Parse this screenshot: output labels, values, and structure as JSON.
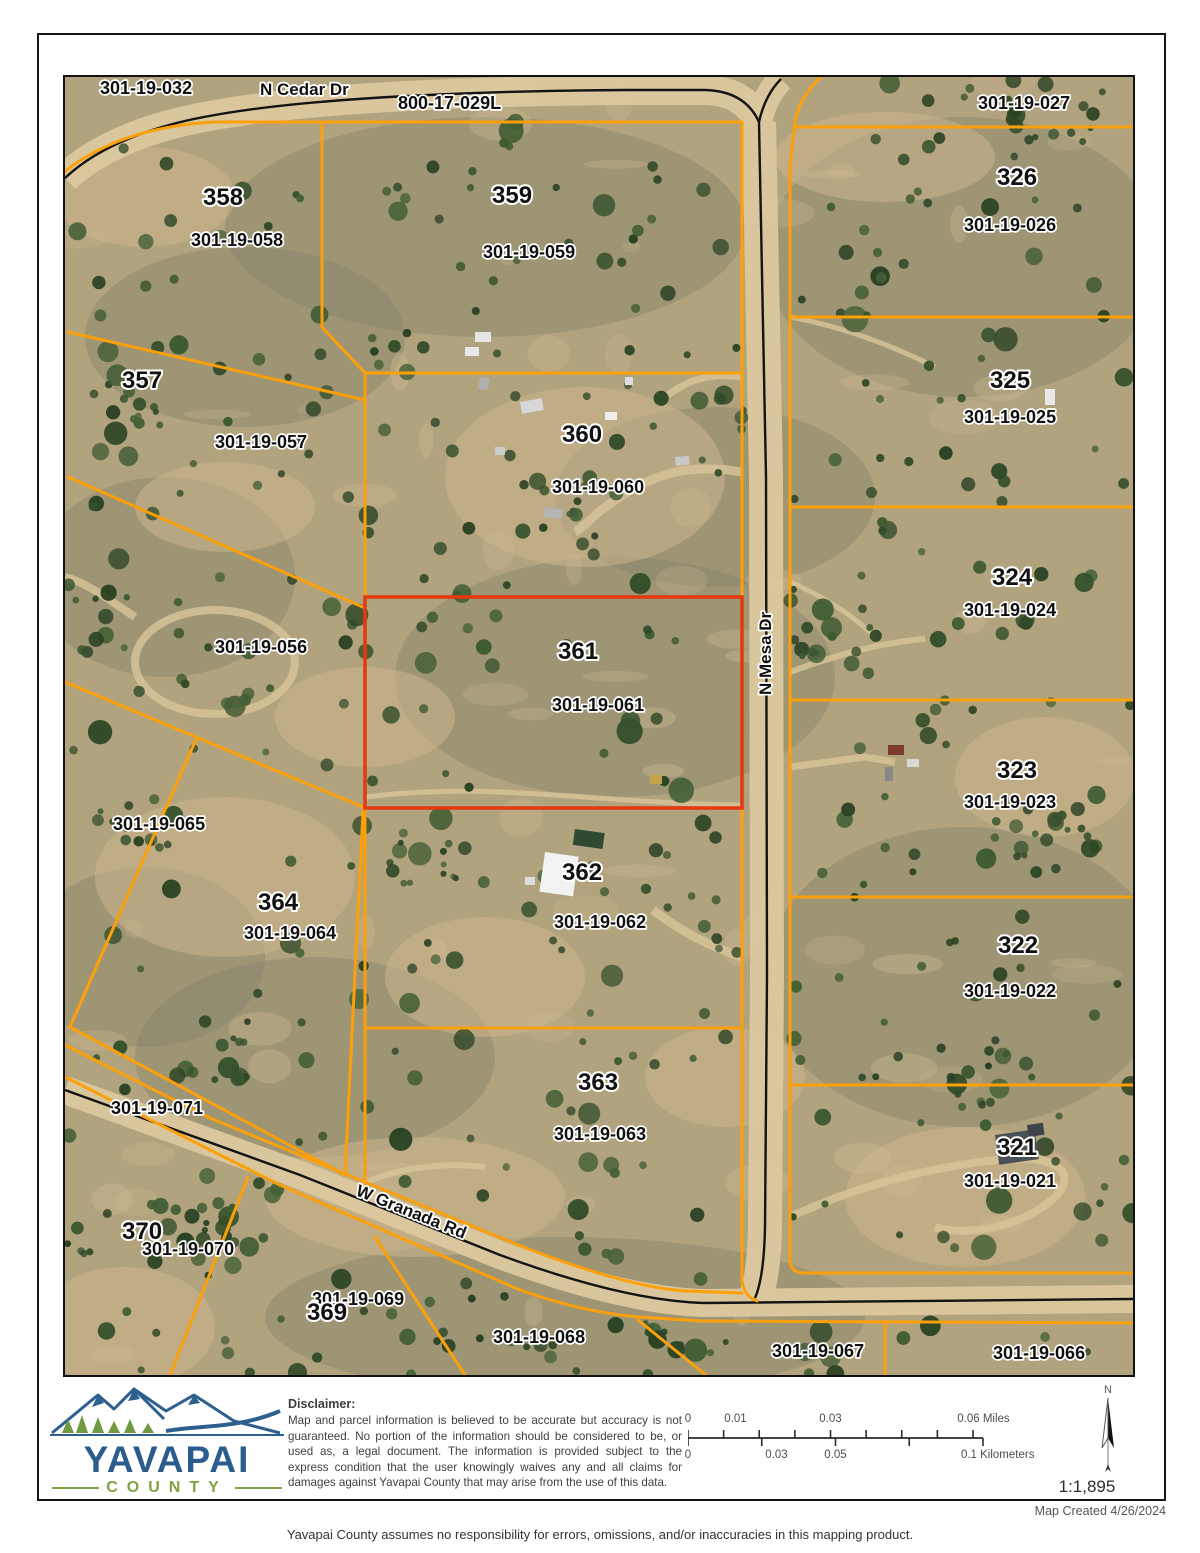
{
  "map": {
    "orange": "#fca00a",
    "highlight": "#e5380e",
    "labels": [
      {
        "text": "301-19-032",
        "x": 35,
        "y": 17,
        "size": 18,
        "kind": "apn"
      },
      {
        "text": "N Cedar Dr",
        "x": 195,
        "y": 18,
        "size": 17,
        "kind": "road"
      },
      {
        "text": "800-17-029L",
        "x": 333,
        "y": 32,
        "size": 18,
        "kind": "apn"
      },
      {
        "text": "358",
        "x": 138,
        "y": 128,
        "size": 24,
        "kind": "num"
      },
      {
        "text": "301-19-058",
        "x": 126,
        "y": 169,
        "size": 18,
        "kind": "apn"
      },
      {
        "text": "359",
        "x": 427,
        "y": 126,
        "size": 24,
        "kind": "num"
      },
      {
        "text": "301-19-059",
        "x": 418,
        "y": 181,
        "size": 18,
        "kind": "apn"
      },
      {
        "text": "357",
        "x": 57,
        "y": 311,
        "size": 24,
        "kind": "num"
      },
      {
        "text": "301-19-057",
        "x": 150,
        "y": 371,
        "size": 18,
        "kind": "apn"
      },
      {
        "text": "301-19-056",
        "x": 150,
        "y": 576,
        "size": 18,
        "kind": "apn"
      },
      {
        "text": "360",
        "x": 497,
        "y": 365,
        "size": 24,
        "kind": "num"
      },
      {
        "text": "301-19-060",
        "x": 487,
        "y": 416,
        "size": 18,
        "kind": "apn"
      },
      {
        "text": "361",
        "x": 493,
        "y": 582,
        "size": 24,
        "kind": "num"
      },
      {
        "text": "301-19-061",
        "x": 487,
        "y": 634,
        "size": 18,
        "kind": "apn"
      },
      {
        "text": "N Mesa Dr",
        "x": 706,
        "y": 618,
        "size": 17,
        "kind": "road",
        "rot": -90
      },
      {
        "text": "301-19-027",
        "x": 913,
        "y": 32,
        "size": 18,
        "kind": "apn"
      },
      {
        "text": "326",
        "x": 932,
        "y": 108,
        "size": 24,
        "kind": "num"
      },
      {
        "text": "301-19-026",
        "x": 899,
        "y": 154,
        "size": 18,
        "kind": "apn"
      },
      {
        "text": "325",
        "x": 925,
        "y": 311,
        "size": 24,
        "kind": "num"
      },
      {
        "text": "301-19-025",
        "x": 899,
        "y": 346,
        "size": 18,
        "kind": "apn"
      },
      {
        "text": "324",
        "x": 927,
        "y": 508,
        "size": 24,
        "kind": "num"
      },
      {
        "text": "301-19-024",
        "x": 899,
        "y": 539,
        "size": 18,
        "kind": "apn"
      },
      {
        "text": "323",
        "x": 932,
        "y": 701,
        "size": 24,
        "kind": "num"
      },
      {
        "text": "301-19-023",
        "x": 899,
        "y": 731,
        "size": 18,
        "kind": "apn"
      },
      {
        "text": "322",
        "x": 933,
        "y": 876,
        "size": 24,
        "kind": "num"
      },
      {
        "text": "301-19-022",
        "x": 899,
        "y": 920,
        "size": 18,
        "kind": "apn"
      },
      {
        "text": "321",
        "x": 932,
        "y": 1078,
        "size": 24,
        "kind": "num"
      },
      {
        "text": "301-19-021",
        "x": 899,
        "y": 1110,
        "size": 18,
        "kind": "apn"
      },
      {
        "text": "301-19-065",
        "x": 48,
        "y": 753,
        "size": 18,
        "kind": "apn"
      },
      {
        "text": "364",
        "x": 193,
        "y": 833,
        "size": 24,
        "kind": "num"
      },
      {
        "text": "301-19-064",
        "x": 179,
        "y": 862,
        "size": 18,
        "kind": "apn"
      },
      {
        "text": "362",
        "x": 497,
        "y": 803,
        "size": 24,
        "kind": "num"
      },
      {
        "text": "301-19-062",
        "x": 489,
        "y": 851,
        "size": 18,
        "kind": "apn"
      },
      {
        "text": "363",
        "x": 513,
        "y": 1013,
        "size": 24,
        "kind": "num"
      },
      {
        "text": "301-19-063",
        "x": 489,
        "y": 1063,
        "size": 18,
        "kind": "apn"
      },
      {
        "text": "301-19-071",
        "x": 46,
        "y": 1037,
        "size": 18,
        "kind": "apn"
      },
      {
        "text": "W Granada Rd",
        "x": 290,
        "y": 1118,
        "size": 17,
        "kind": "road",
        "rot": 22
      },
      {
        "text": "370",
        "x": 57,
        "y": 1162,
        "size": 24,
        "kind": "num"
      },
      {
        "text": "301-19-070",
        "x": 77,
        "y": 1178,
        "size": 18,
        "kind": "apn"
      },
      {
        "text": "301-19-069",
        "x": 247,
        "y": 1228,
        "size": 18,
        "kind": "apn"
      },
      {
        "text": "369",
        "x": 242,
        "y": 1243,
        "size": 24,
        "kind": "num"
      },
      {
        "text": "301-19-068",
        "x": 428,
        "y": 1266,
        "size": 18,
        "kind": "apn"
      },
      {
        "text": "301-19-067",
        "x": 707,
        "y": 1280,
        "size": 18,
        "kind": "apn"
      },
      {
        "text": "301-19-066",
        "x": 928,
        "y": 1282,
        "size": 18,
        "kind": "apn"
      }
    ]
  },
  "footer": {
    "logo_title": "YAVAPAI",
    "logo_subtitle": "COUNTY",
    "disclaimer_title": "Disclaimer:",
    "disclaimer_body": "Map and parcel information is believed to be accurate but accuracy is not guaranteed. No portion of the information should be considered to be, or used as, a legal document. The information is provided subject to the express condition that the user knowingly waives any and all claims for damages against Yavapai County that may arise from the use of this data.",
    "north_label": "N",
    "scale_ratio": "1:1,895",
    "scale_miles": [
      {
        "label": "0",
        "frac": 0
      },
      {
        "label": "0.01",
        "frac": 0.1667
      },
      {
        "label": "0.03",
        "frac": 0.5
      },
      {
        "label": "0.06 Miles",
        "frac": 1
      }
    ],
    "scale_km": [
      {
        "label": "0",
        "frac": 0
      },
      {
        "label": "0.03",
        "frac": 0.3
      },
      {
        "label": "0.05",
        "frac": 0.5
      },
      {
        "label": "0.1 Kilometers",
        "frac": 1
      }
    ]
  },
  "bottom": {
    "map_created": "Map Created 4/26/2024",
    "disclaimer": "Yavapai County assumes no responsibility for errors, omissions, and/or inaccuracies in this mapping product."
  }
}
